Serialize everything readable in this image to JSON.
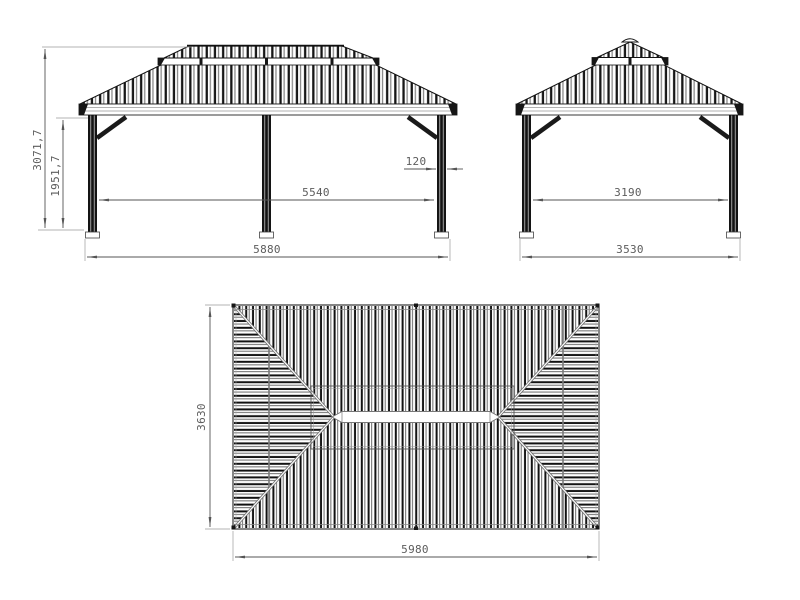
{
  "drawing": {
    "front_view": {
      "total_height_label": "3071,7",
      "post_height_label": "1951,7",
      "inner_span_label": "5540",
      "post_width_label": "120",
      "total_width_label": "5880"
    },
    "side_view": {
      "inner_span_label": "3190",
      "total_width_label": "3530"
    },
    "plan_view": {
      "depth_label": "3630",
      "width_label": "5980"
    },
    "colors": {
      "line": "#111111",
      "dimension": "#555555",
      "stripe_dark": "#161616",
      "stripe_gray": "#8a8a8a",
      "background": "#ffffff"
    }
  }
}
